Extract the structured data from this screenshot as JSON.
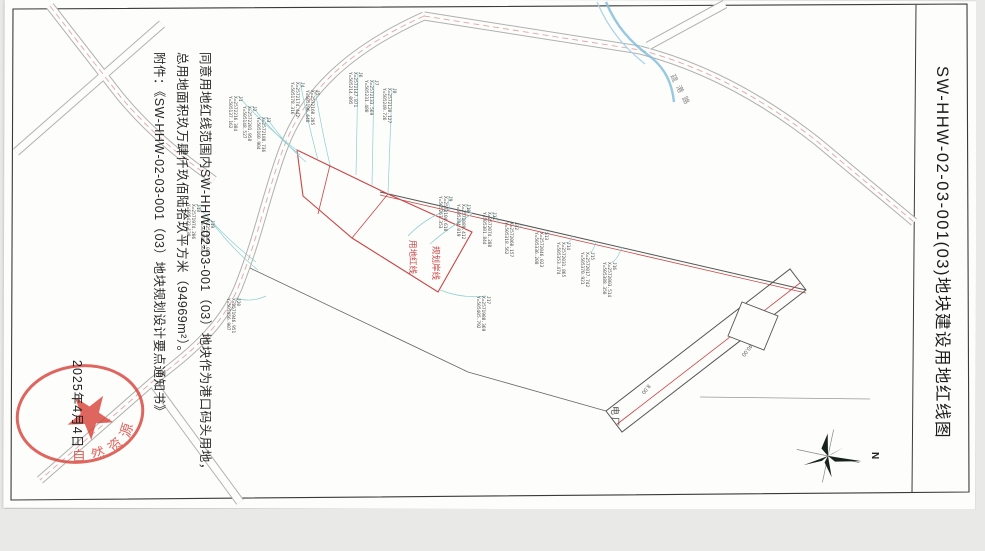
{
  "sheet": {
    "title": "SW-HHW-02-03-001(03)地块建设用地红线图"
  },
  "approval": {
    "line1": "同意用地红线范围内SW-HHW-02-03-001（03）地块作为港口码头用地，",
    "line2": "总用地面积玖万肆仟玖佰陆拾玖平方米（94969m²）。",
    "line3": "附件：《SW-HHW-02-03-001（03）地块规划设计要点通知书》",
    "date": "2025年4月4日"
  },
  "seal": {
    "arc_text": "自然资源",
    "color": "#d9453c"
  },
  "map": {
    "north_label": "N",
    "road_name_label": "疏港路",
    "site_label": "电厂",
    "red_line_labels": [
      "用地红线",
      "规划岸线"
    ],
    "dimensions": [
      "40.00",
      "8.00"
    ],
    "colors": {
      "red_line": "#c94545",
      "road_casing": "#b0b0b0",
      "road_center_dash": "#dda8a8",
      "stream": "#85bedc",
      "leader": "#8fcfcf",
      "boundary": "#555555"
    },
    "coordinate_points": [
      {
        "id": "J1",
        "lx": 238,
        "ly": 96,
        "tx": 298,
        "ty": 151,
        "x_label": "X=2572216.384",
        "y_label": "Y=505137.162"
      },
      {
        "id": "J2",
        "lx": 252,
        "ly": 106,
        "tx": 300,
        "ty": 155,
        "x_label": "X=2572201.958",
        "y_label": "Y=505148.527"
      },
      {
        "id": "J3",
        "lx": 266,
        "ly": 117,
        "tx": 306,
        "ty": 162,
        "x_label": "X=2572188.736",
        "y_label": "Y=505160.904"
      },
      {
        "id": "J4",
        "lx": 300,
        "ly": 82,
        "tx": 318,
        "ty": 160,
        "x_label": "X=2572174.442",
        "y_label": "Y=505178.316"
      },
      {
        "id": "J5",
        "lx": 315,
        "ly": 90,
        "tx": 330,
        "ty": 165,
        "x_label": "X=2572160.205",
        "y_label": "Y=505196.648"
      },
      {
        "id": "J6",
        "lx": 358,
        "ly": 72,
        "tx": 356,
        "ty": 175,
        "x_label": "X=2572147.871",
        "y_label": "Y=505214.095"
      },
      {
        "id": "J7",
        "lx": 374,
        "ly": 80,
        "tx": 372,
        "ty": 186,
        "x_label": "X=2572133.569",
        "y_label": "Y=505231.480"
      },
      {
        "id": "J8",
        "lx": 392,
        "ly": 88,
        "tx": 388,
        "ty": 194,
        "x_label": "X=2572120.127",
        "y_label": "Y=505249.726"
      },
      {
        "id": "J9",
        "lx": 448,
        "ly": 196,
        "tx": 450,
        "ty": 208,
        "x_label": "X=2572104.618",
        "y_label": "Y=505267.353"
      },
      {
        "id": "J10",
        "lx": 466,
        "ly": 204,
        "tx": 472,
        "ty": 213,
        "x_label": "X=2572089.412",
        "y_label": "Y=505284.019"
      },
      {
        "id": "J11",
        "lx": 492,
        "ly": 212,
        "tx": 500,
        "ty": 220,
        "x_label": "X=2572074.288",
        "y_label": "Y=505301.844"
      },
      {
        "id": "J12",
        "lx": 514,
        "ly": 222,
        "tx": 522,
        "ty": 225,
        "x_label": "X=2572060.157",
        "y_label": "Y=505318.562"
      },
      {
        "id": "J13",
        "lx": 544,
        "ly": 232,
        "tx": 548,
        "ty": 231,
        "x_label": "X=2572046.023",
        "y_label": "Y=505336.208"
      },
      {
        "id": "J14",
        "lx": 566,
        "ly": 242,
        "tx": 572,
        "ty": 236,
        "x_label": "X=2572031.865",
        "y_label": "Y=505353.474"
      },
      {
        "id": "J15",
        "lx": 590,
        "ly": 252,
        "tx": 596,
        "ty": 241,
        "x_label": "X=2572017.742",
        "y_label": "Y=505370.921"
      },
      {
        "id": "J16",
        "lx": 612,
        "ly": 262,
        "tx": 622,
        "ty": 247,
        "x_label": "X=2572003.514",
        "y_label": "Y=505388.350"
      },
      {
        "id": "J17",
        "lx": 486,
        "ly": 296,
        "tx": 440,
        "ty": 290,
        "x_label": "X=2571988.369",
        "y_label": "Y=505405.792"
      },
      {
        "id": "J18",
        "lx": 196,
        "ly": 204,
        "tx": 256,
        "ty": 262,
        "x_label": "X=2571974.206",
        "y_label": "Y=505422.138"
      },
      {
        "id": "J19",
        "lx": 210,
        "ly": 220,
        "tx": 258,
        "ty": 270,
        "x_label": "X=2571960.088",
        "y_label": "Y=505439.564"
      },
      {
        "id": "J20",
        "lx": 236,
        "ly": 298,
        "tx": 266,
        "ty": 296,
        "x_label": "X=2571946.951",
        "y_label": "Y=505456.907"
      }
    ]
  }
}
